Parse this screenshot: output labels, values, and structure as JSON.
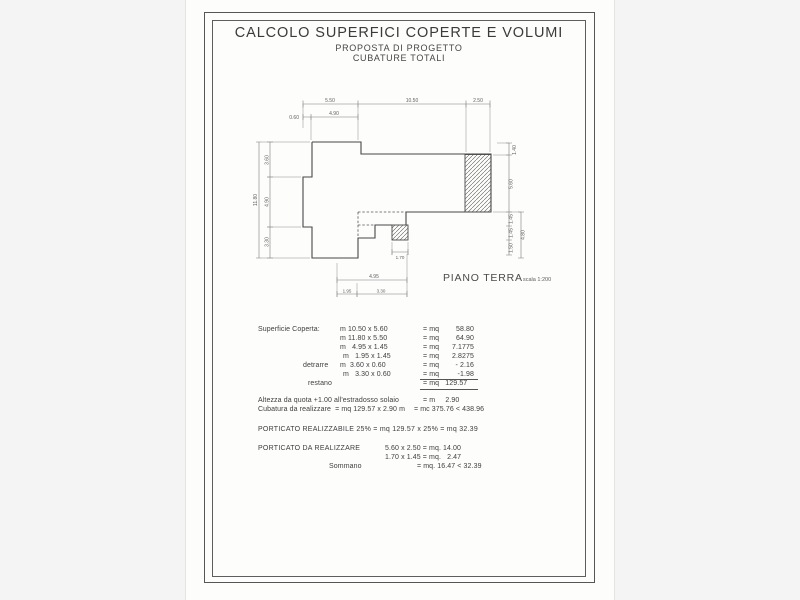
{
  "header": {
    "title": "CALCOLO SUPERFICI COPERTE E VOLUMI",
    "subtitle1": "PROPOSTA DI PROGETTO",
    "subtitle2": "CUBATURE TOTALI"
  },
  "plan": {
    "name": "PIANO TERRA",
    "scale": "scala 1:200",
    "dims": {
      "top": [
        "5.50",
        "10.50",
        "2.50"
      ],
      "top2": [
        "0.60",
        "4.90"
      ],
      "left": {
        "total": "11.80",
        "segments": [
          "3.60",
          "4.90",
          "3.30"
        ]
      },
      "right": {
        "segments": [
          "1.40",
          "5.60",
          "1.45",
          "1.45",
          "1.50"
        ],
        "outer": "4.80"
      },
      "bottom": [
        "1.70",
        "4.95",
        "1.95",
        "3.30"
      ]
    }
  },
  "calc": {
    "surface": {
      "label": "Superficie Coperta:",
      "rows": [
        {
          "formula": "m 10.50 x 5.60",
          "eq": "= mq",
          "value": "58.80"
        },
        {
          "formula": "m 11.80 x 5.50",
          "eq": "= mq",
          "value": "64.90"
        },
        {
          "formula": "m   4.95 x 1.45",
          "eq": "= mq",
          "value": "7.1775"
        },
        {
          "formula": "m   1.95 x 1.45",
          "eq": "= mq",
          "value": "2.8275"
        },
        {
          "prefix": "detrarre",
          "formula": "m  3.60 x 0.60",
          "eq": "= mq",
          "value": "- 2.16"
        },
        {
          "formula": "m   3.30 x 0.60",
          "eq": "= mq",
          "value": "-1.98"
        },
        {
          "prefix": "restano",
          "total": "= mq   129.57"
        }
      ]
    },
    "altezza": {
      "label": "Altezza da quota +1.00 all'estradosso solaio",
      "result": "= m     2.90"
    },
    "cubatura": {
      "label": "Cubatura da realizzare  = mq 129.57 x 2.90 m",
      "result": "= mc 375.76 < 438.96"
    },
    "porticato_realizzabile": "PORTICATO REALIZZABILE 25% = mq 129.57 x 25% = mq 32.39",
    "porticato": {
      "label": "PORTICATO DA REALIZZARE",
      "row1": "5.60 x 2.50 = mq. 14.00",
      "row2": "1.70 x 1.45 = mq.   2.47",
      "sommano_label": "Sommano",
      "sommano_value": "= mq. 16.47 < 32.39"
    }
  }
}
